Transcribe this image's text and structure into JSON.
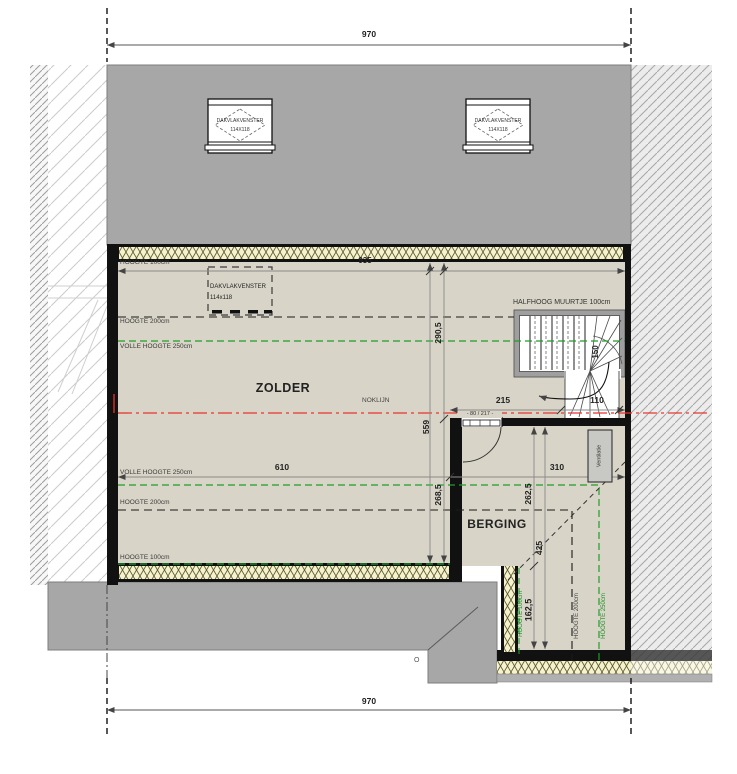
{
  "dimensions": {
    "overall_top": "970",
    "overall_bottom": "970",
    "inner_width": "935",
    "zolder_width": "610",
    "berging_width": "310",
    "stair_top": "215",
    "stair_side": "110",
    "stair_width": "150",
    "left_total_height": "559",
    "upper_depth": "290,5",
    "lower_depth": "268,5",
    "berging_depth": "262,5",
    "berging_total": "425",
    "berging_extension": "162,5",
    "door_size": "- 80 / 217 -"
  },
  "rooms": {
    "zolder": "ZOLDER",
    "berging": "BERGING"
  },
  "annotations": {
    "noklijn": "NOKLIJN",
    "halfhoog_muurtje": "HALFHOOG MUURTJE 100cm",
    "ventilatie": "Ventilatie",
    "corner_marker": "O"
  },
  "height_lines_left": [
    "HOOGTE 100cm",
    "HOOGTE 200cm",
    "VOLLE HOOGTE 250cm",
    "VOLLE HOOGTE 250cm",
    "HOOGTE 200cm",
    "HOOGTE 100cm"
  ],
  "height_lines_right": [
    "HOOGTE 100cm",
    "HOOGTE 200cm",
    "HOOGTE 250cm"
  ],
  "roof_windows": {
    "window_left": {
      "name": "DAKVLAKVENSTER",
      "size": "114X118"
    },
    "window_right": {
      "name": "DAKVLAKVENSTER",
      "size": "114X118"
    },
    "window_planned": {
      "name": "DAKVLAKVENSTER",
      "size": "114x118"
    }
  },
  "colors": {
    "roof_gray": "#a7a7a7",
    "floor_beige": "#d8d4c7",
    "insulation_yellow": "#f6f2cd",
    "height_green": "#1e9e28",
    "ridge_red": "#e8352c",
    "half_wall_gray": "#9f9f9f"
  }
}
